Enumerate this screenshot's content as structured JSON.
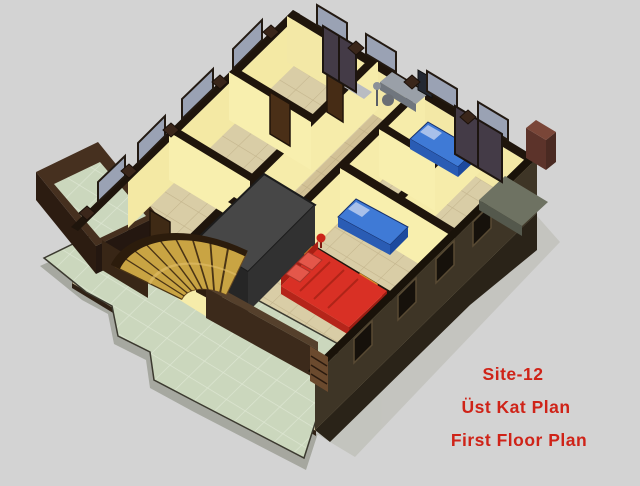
{
  "image": {
    "description": "3D isometric cut-away architectural rendering of a residential first (upper) floor plan, viewed from above at an angle, on a plain light gray background",
    "render_type": "architectural-3d-cutaway"
  },
  "caption": {
    "lines": [
      "Site-12",
      "Üst Kat Plan",
      "First Floor Plan"
    ],
    "color": "#cf2318"
  },
  "palette": {
    "background": "#d3d3d3",
    "interior_wall_cream": "#f6ecaa",
    "wall_cut_cap_dark": "#1f150c",
    "floor_tile_beige": "#d9cda6",
    "hall_tile_tan": "#d2c196",
    "terrace_tile_green": "#cbd7bd",
    "exterior_wall_brown": "#3e3526",
    "parapet_brown": "#46301f",
    "stair_wood": "#c9a443",
    "stairwell_gray": "#474747",
    "bed_red": "#d93025",
    "bed_blue": "#3f7ad6",
    "nightstand_orange": "#d98a28",
    "lamp_red": "#cc2418",
    "window_glass": "#9aa2b4",
    "chimney_red_brown": "#7a4638"
  },
  "scene": {
    "elements": [
      {
        "name": "terrace",
        "color": "#cbd7bd",
        "note": "large pale-green tiled terrace wrapping lower-left of building"
      },
      {
        "name": "balcony",
        "color": "#cbd7bd",
        "note": "small green-tiled balcony with brown parapet, upper left"
      },
      {
        "name": "curved-staircase",
        "color": "#c9a443",
        "note": "fan-shaped curved wooden stair descending to terrace"
      },
      {
        "name": "stairwell-core",
        "color": "#474747",
        "note": "dark gray stair enclosure volume at center"
      },
      {
        "name": "master-bed",
        "color": "#d93025",
        "note": "red double bed with pillows, lower-center bedroom"
      },
      {
        "name": "single-bed-middle",
        "color": "#3f7ad6",
        "note": "blue single bed, middle bedroom"
      },
      {
        "name": "single-bed-top-right",
        "color": "#3f7ad6",
        "note": "blue single bed, top-right bedroom"
      },
      {
        "name": "nightstand-1",
        "color": "#d98a28"
      },
      {
        "name": "nightstand-2",
        "color": "#d98a28"
      },
      {
        "name": "table-lamp",
        "color": "#cc2418"
      },
      {
        "name": "computer-desk-with-monitor",
        "color": "#9aa0a8"
      },
      {
        "name": "wardrobe-doors",
        "color": "#4a2f17"
      },
      {
        "name": "cut-wall-windows",
        "color": "#9aa2b4"
      },
      {
        "name": "chimney",
        "color": "#7a4638"
      }
    ]
  }
}
